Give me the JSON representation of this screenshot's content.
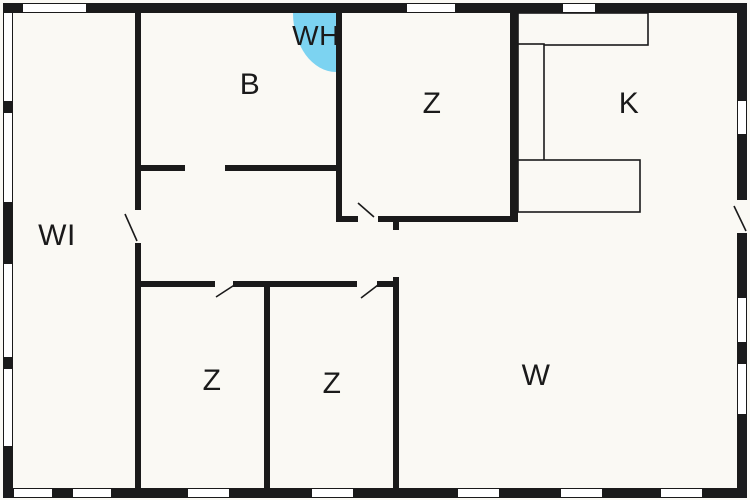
{
  "plan": {
    "title": "Apartment floor plan",
    "rooms": [
      {
        "id": "wi",
        "label": "WI"
      },
      {
        "id": "b",
        "label": "B"
      },
      {
        "id": "wh",
        "label": "WH"
      },
      {
        "id": "z-top",
        "label": "Z"
      },
      {
        "id": "k",
        "label": "K"
      },
      {
        "id": "z-bottom-left",
        "label": "Z"
      },
      {
        "id": "z-bottom-mid",
        "label": "Z"
      },
      {
        "id": "w",
        "label": "W"
      }
    ],
    "colors": {
      "wall": "#1a1a1a",
      "background": "#faf9f4",
      "window": "#ffffff",
      "accent": "#7cd3f1"
    }
  }
}
